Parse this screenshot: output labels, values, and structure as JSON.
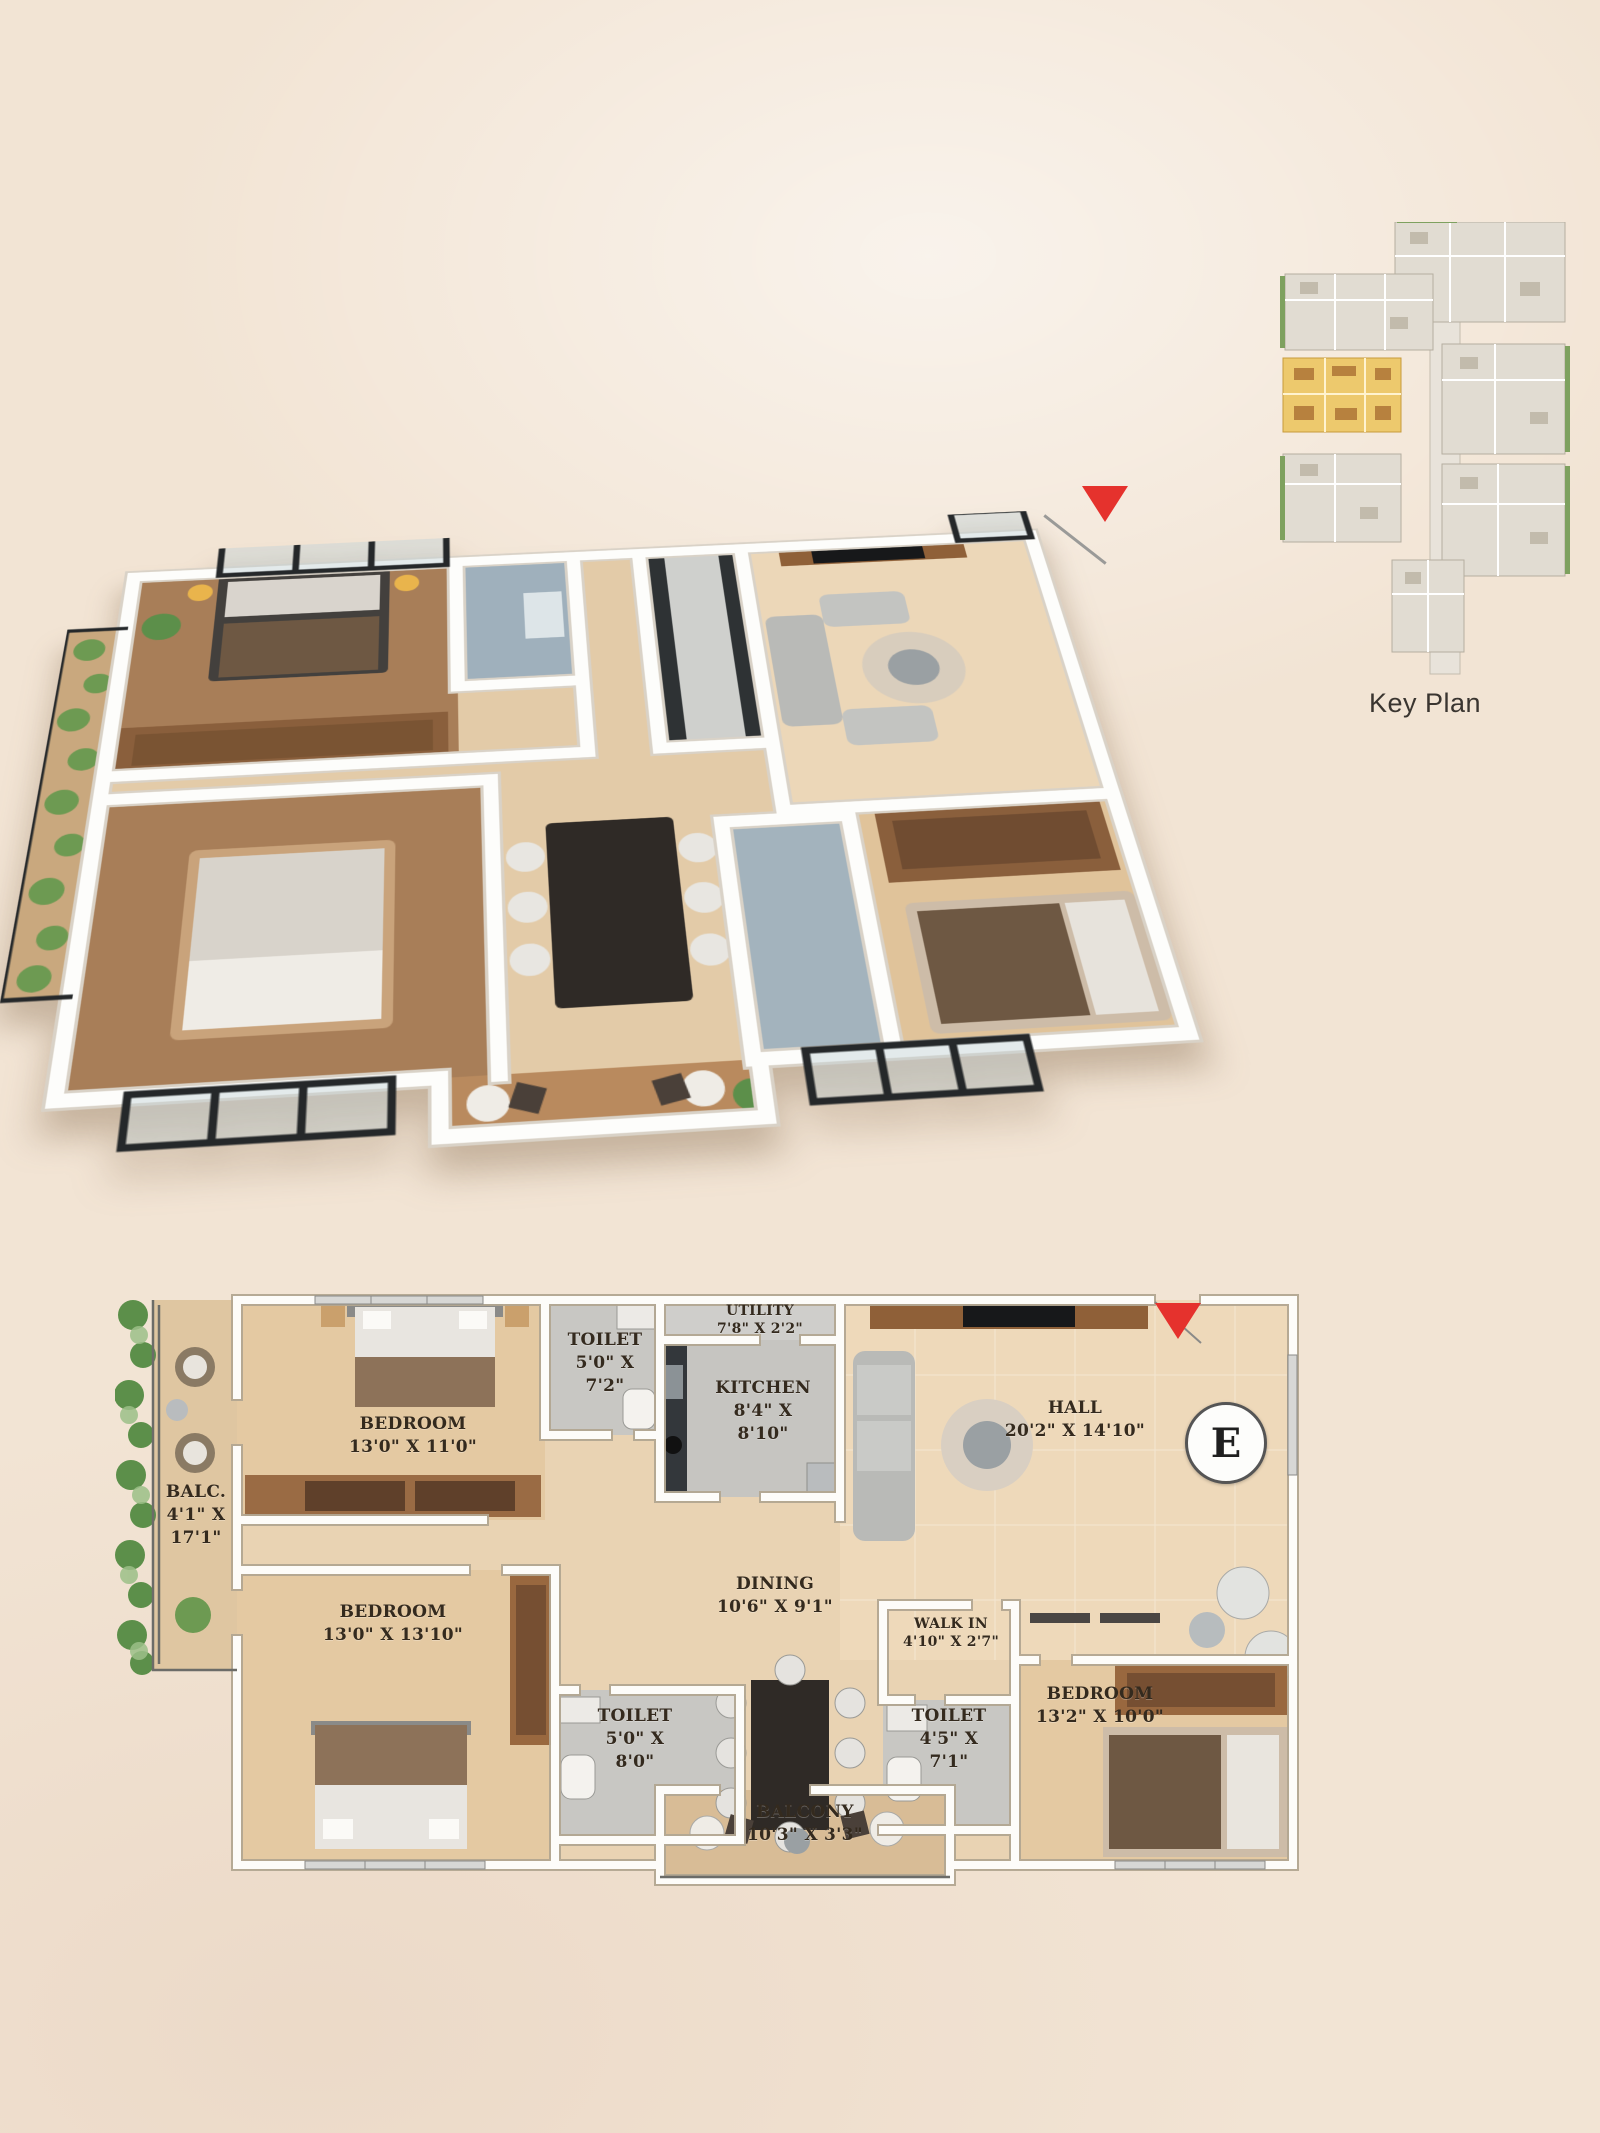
{
  "background": {
    "color": "#f2e4d4"
  },
  "key_plan": {
    "label": "Key Plan",
    "highlight_color": "#edc96d"
  },
  "plan_3d": {
    "description": "isometric-3d-unit-render",
    "entrance_marker_color": "#e5322d"
  },
  "plan_2d": {
    "compass_letter": "E",
    "entrance_marker_color": "#e5322d",
    "rooms": [
      {
        "id": "bedroom-1",
        "name": "BEDROOM",
        "dims1": "13'0\" X 11'0\"",
        "dims2": ""
      },
      {
        "id": "toilet-1",
        "name": "TOILET",
        "dims1": "5'0\" X",
        "dims2": "7'2\""
      },
      {
        "id": "utility",
        "name": "UTILITY",
        "dims1": "7'8\" X 2'2\"",
        "dims2": ""
      },
      {
        "id": "kitchen",
        "name": "KITCHEN",
        "dims1": "8'4\" X",
        "dims2": "8'10\""
      },
      {
        "id": "hall",
        "name": "HALL",
        "dims1": "20'2\" X 14'10\"",
        "dims2": ""
      },
      {
        "id": "balc-left",
        "name": "BALC.",
        "dims1": "4'1\" X",
        "dims2": "17'1\""
      },
      {
        "id": "bedroom-2",
        "name": "BEDROOM",
        "dims1": "13'0\" X 13'10\"",
        "dims2": ""
      },
      {
        "id": "dining",
        "name": "DINING",
        "dims1": "10'6\" X 9'1\"",
        "dims2": ""
      },
      {
        "id": "walk-in",
        "name": "WALK IN",
        "dims1": "4'10\" X 2'7\"",
        "dims2": ""
      },
      {
        "id": "toilet-2",
        "name": "TOILET",
        "dims1": "5'0\" X",
        "dims2": "8'0\""
      },
      {
        "id": "toilet-3",
        "name": "TOILET",
        "dims1": "4'5\" X",
        "dims2": "7'1\""
      },
      {
        "id": "bedroom-3",
        "name": "BEDROOM",
        "dims1": "13'2\" X 10'0\"",
        "dims2": ""
      },
      {
        "id": "balcony",
        "name": "BALCONY",
        "dims1": "10'3\" X 3'3\"",
        "dims2": ""
      }
    ]
  }
}
